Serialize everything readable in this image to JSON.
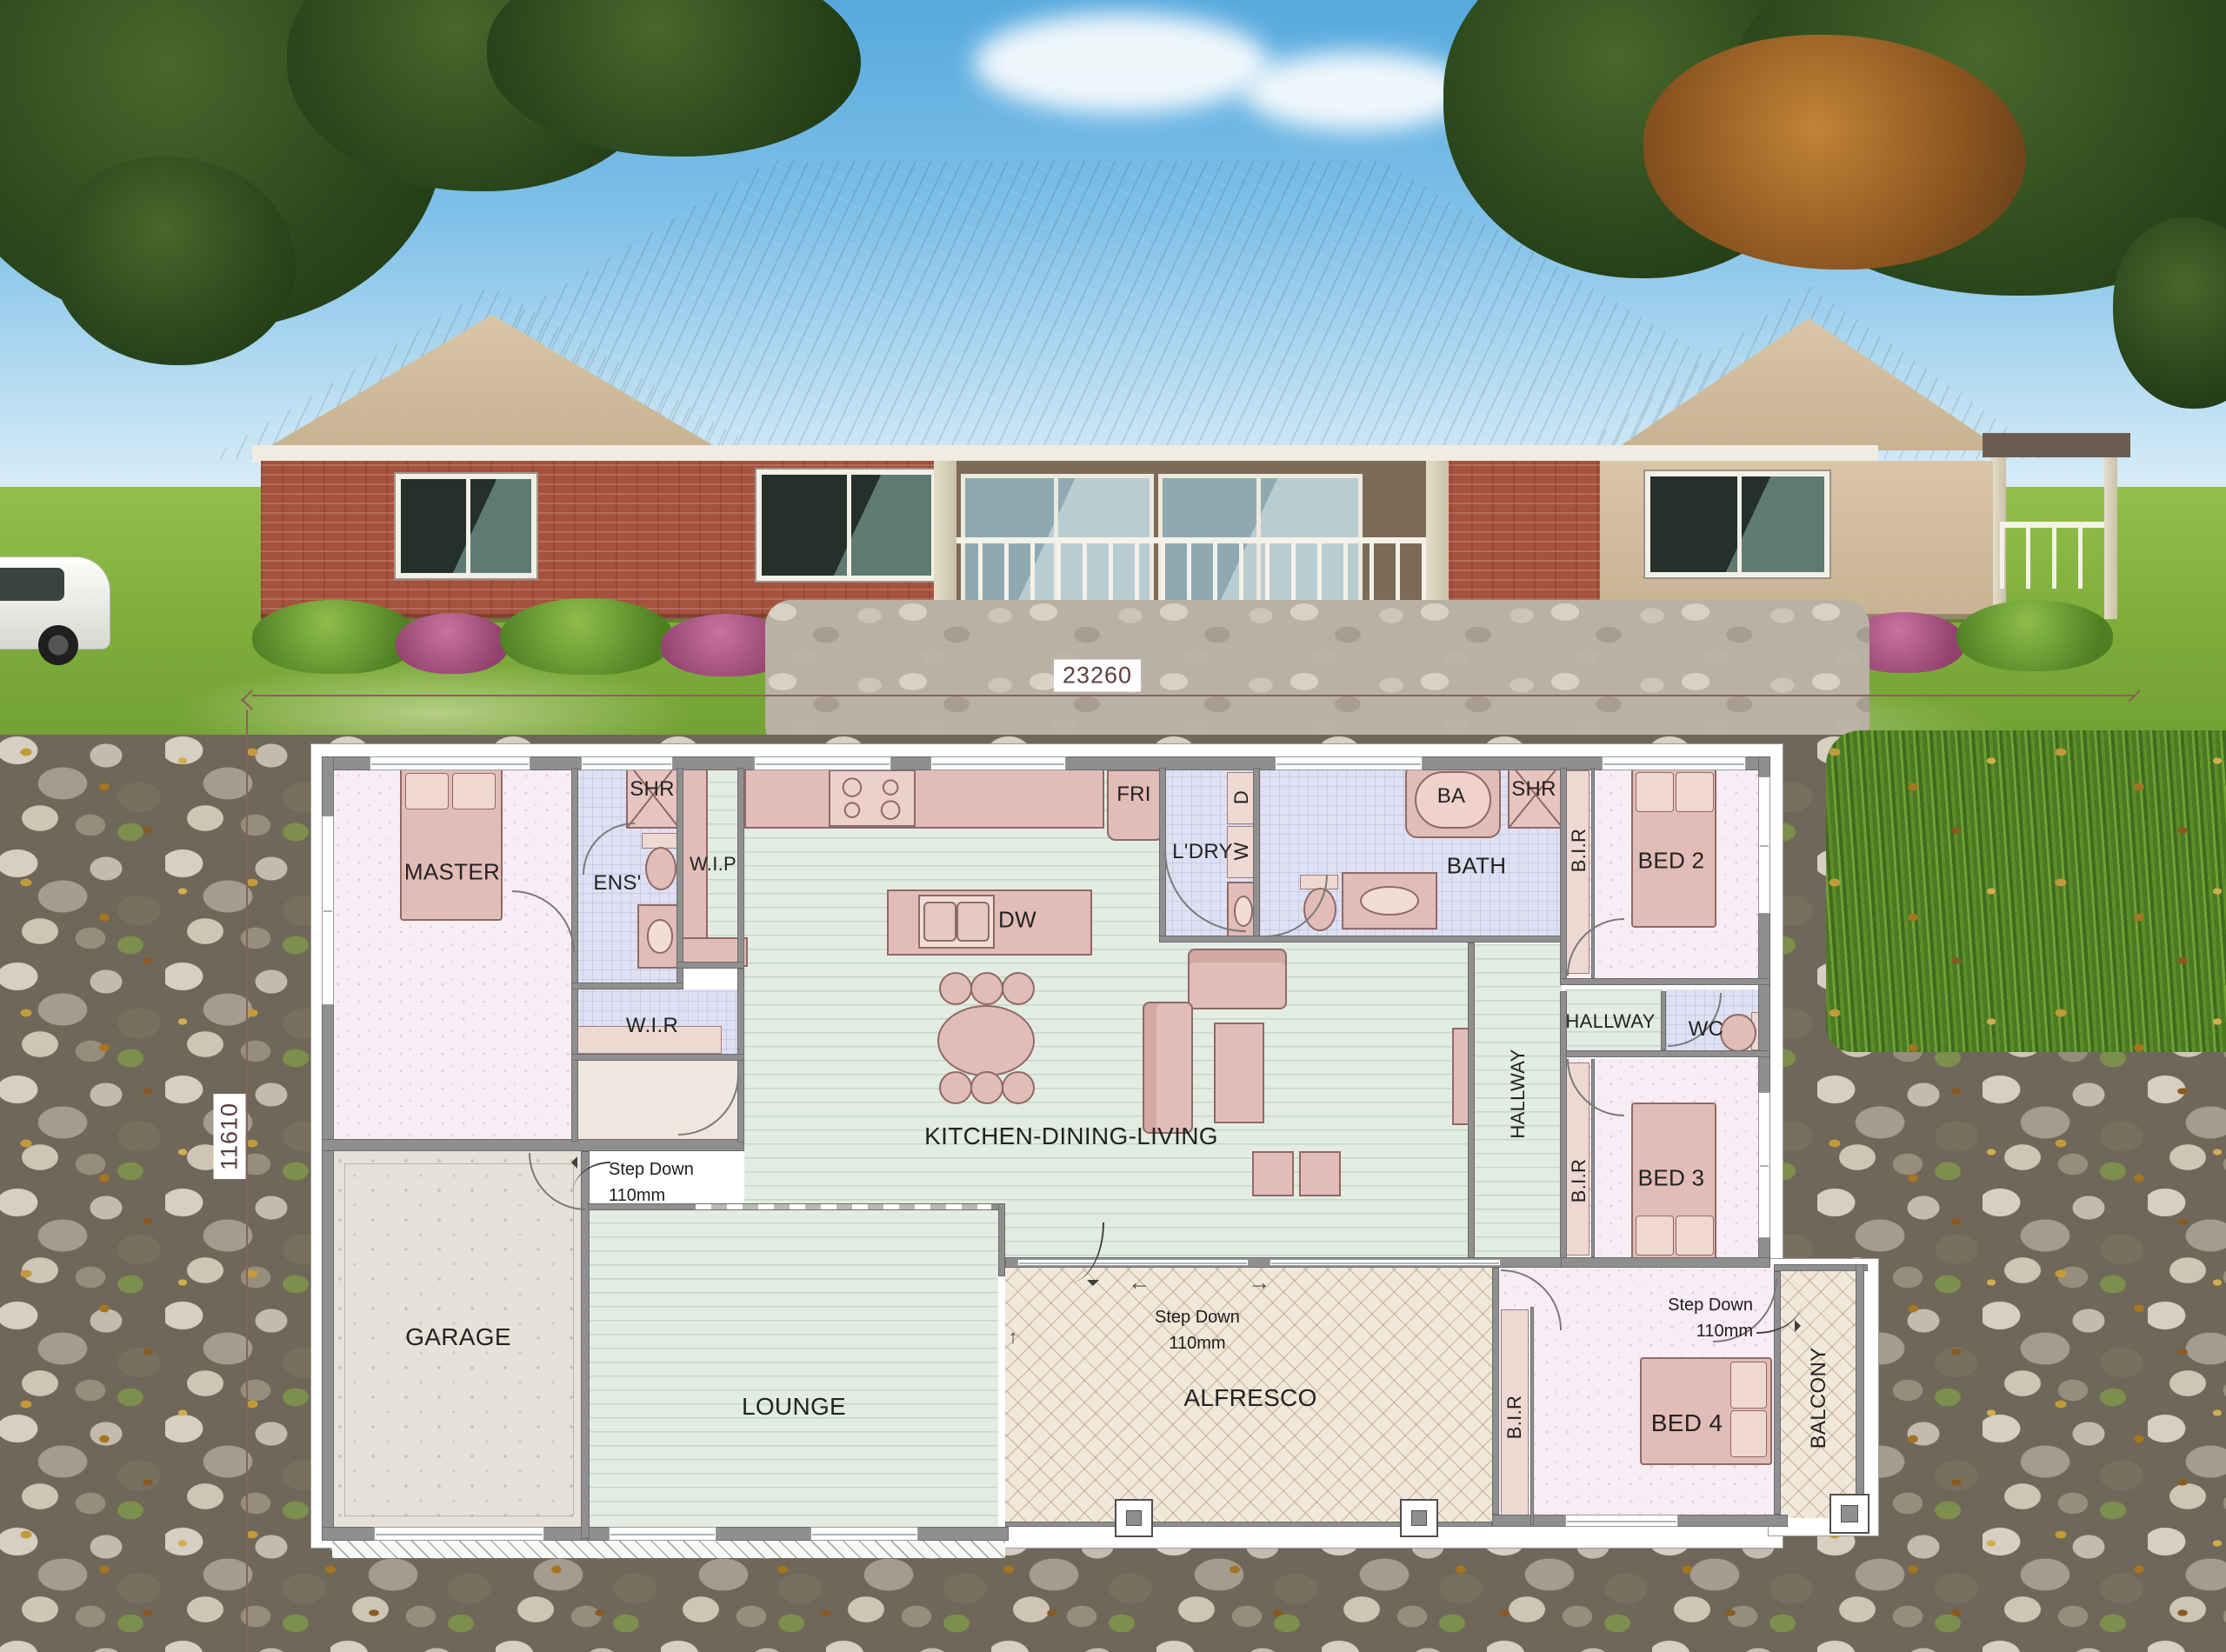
{
  "plan": {
    "dimensions": {
      "width": "23260",
      "height": "11610"
    },
    "rooms": {
      "master": "MASTER",
      "ens": "ENS'",
      "shr_ens": "SHR",
      "wip": "W.I.P",
      "wir": "W.I.R",
      "fridge": "FRI",
      "ldry": "L'DRY",
      "dryer": "D",
      "washer": "W",
      "ba": "BA",
      "bath": "BATH",
      "shr_bath": "SHR",
      "bir_bed2": "B.I.R",
      "bed2": "BED 2",
      "hallway_upper": "HALLWAY",
      "wc": "WC",
      "dishwasher": "DW",
      "kitchen_dining_living": "KITCHEN-DINING-LIVING",
      "hallway_main": "HALLWAY",
      "bir_bed3": "B.I.R",
      "bed3": "BED 3",
      "garage": "GARAGE",
      "lounge": "LOUNGE",
      "alfresco": "ALFRESCO",
      "bir_bed4": "B.I.R",
      "bed4": "BED 4",
      "balcony": "BALCONY"
    },
    "annotations": {
      "step_down_garage": {
        "line1": "Step Down",
        "line2": "110mm"
      },
      "step_down_alfresco": {
        "line1": "Step Down",
        "line2": "110mm"
      },
      "step_down_balcony": {
        "line1": "Step Down",
        "line2": "110mm"
      }
    }
  },
  "colors": {
    "floor_bedroom": "#f9edf5",
    "floor_wet": "#dfe1f2",
    "floor_living": "#e3ece2",
    "floor_garage": "#e7e2d8",
    "floor_outdoor": "#f2e8da",
    "floor_hall": "#efe6de",
    "furniture": "#e2bcb7",
    "furniture_line": "#8f6a65",
    "wall": "#8f8f8f",
    "label": "#232323",
    "dim": "#8d5f5a"
  }
}
